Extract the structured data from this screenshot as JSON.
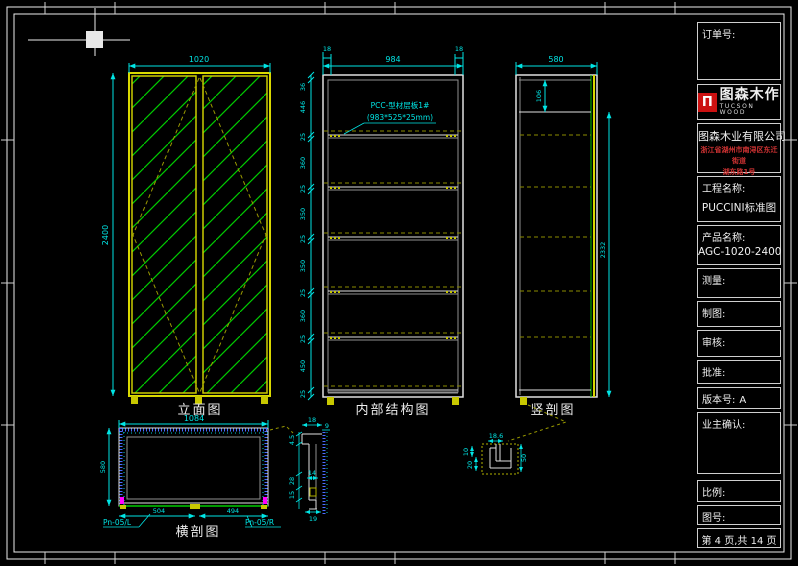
{
  "title_block": {
    "order_label": "订单号:",
    "logo": {
      "mark": "Π",
      "brand": "图森木作",
      "brand_en": "TUCSON WOOD"
    },
    "company_name": "图森木业有限公司",
    "company_address_line1": "浙江省湖州市南浔区东迁街道",
    "company_address_line2": "湖东路1号",
    "project_label": "工程名称:",
    "project_value": "PUCCINI标准图",
    "product_label": "产品名称:",
    "product_value": "AGC-1020-2400",
    "measure_label": "测量:",
    "draft_label": "制图:",
    "review_label": "审核:",
    "approve_label": "批准:",
    "version_label": "版本号:",
    "version_value": "A",
    "owner_confirm_label": "业主确认:",
    "scale_label": "比例:",
    "drawing_no_label": "图号:",
    "page_info": "第 4 页,共 14 页"
  },
  "views": {
    "elevation": {
      "label": "立面图",
      "dim_width": "1020",
      "dim_height": "2400"
    },
    "internal_structure": {
      "label": "内部结构图",
      "dim_top_left": "18",
      "dim_width": "984",
      "dim_top_right": "18",
      "left_dims": [
        "36",
        "446",
        "25",
        "360",
        "25",
        "350",
        "25",
        "350",
        "25",
        "360",
        "25",
        "450",
        "25"
      ],
      "annotation_line1": "PCC-型材层板1#",
      "annotation_line2": "(983*525*25mm)"
    },
    "vertical_section": {
      "label": "竖剖图",
      "dim_depth": "580",
      "dim_top_inner": "106",
      "dim_height": "2332"
    },
    "plan_section": {
      "label": "横剖图",
      "dim_width": "1084",
      "dim_depth": "580",
      "dim_door_left": "504",
      "dim_door_right": "494",
      "tag_left": "Pn-05/L",
      "tag_right": "Pn-05/R"
    },
    "detail_door": {
      "dim_top": "18",
      "dim_top2": "9",
      "dim_a": "4.5",
      "dim_b": "28",
      "dim_c": "15",
      "dim_d": "14",
      "dim_e": "19"
    },
    "detail_base": {
      "dim_top": "18.6",
      "dim_a": "10",
      "dim_b": "20",
      "dim_c": "50"
    }
  },
  "colors": {
    "dimension_cyan": "#00e5e5",
    "frame_yellow": "#d9d900",
    "glass_green": "#00cc00",
    "hatch_blue": "#4a6cff",
    "accent_magenta": "#ff00ff",
    "logo_red": "#cc1111",
    "address_red": "#d23333"
  }
}
